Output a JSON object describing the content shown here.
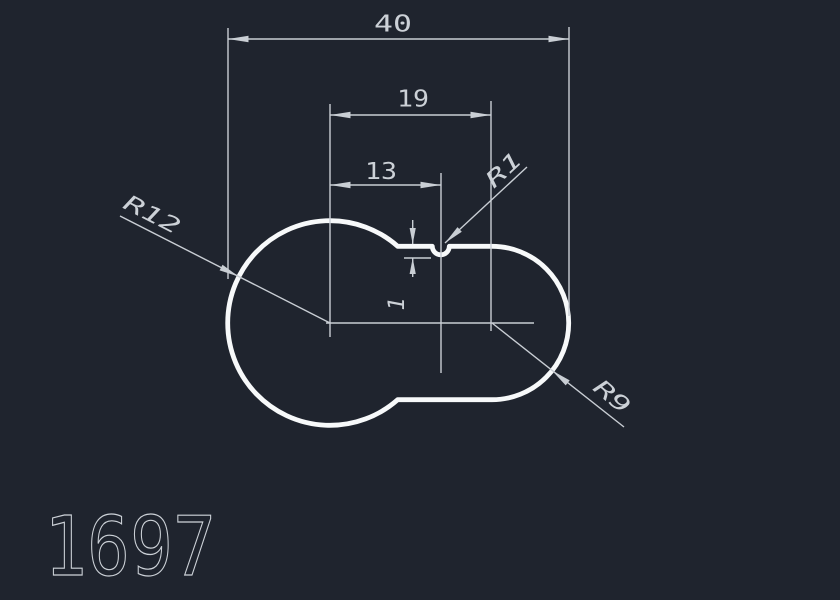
{
  "canvas": {
    "width": 840,
    "height": 600,
    "background": "#1f242e"
  },
  "style": {
    "background": "#1f242e",
    "outline_color": "#f7f9fa",
    "line_color": "#c9ced4",
    "text_color": "#ccd1d7"
  },
  "drawing": {
    "number": "1697",
    "dimensions": {
      "overall_width": {
        "label": "40"
      },
      "center_distance": {
        "label": "19"
      },
      "notch_offset": {
        "label": "13"
      },
      "notch_depth": {
        "label": "1"
      }
    },
    "radii": {
      "left_circle": {
        "label": "R12"
      },
      "notch": {
        "label": "R1"
      },
      "right_circle": {
        "label": "R9"
      }
    },
    "geometry": {
      "overall_width_units": 40,
      "center_distance_units": 19,
      "notch_offset_units": 13,
      "notch_depth_units": 1,
      "left_radius_units": 12,
      "right_radius_units": 9,
      "notch_radius_units": 1
    }
  }
}
